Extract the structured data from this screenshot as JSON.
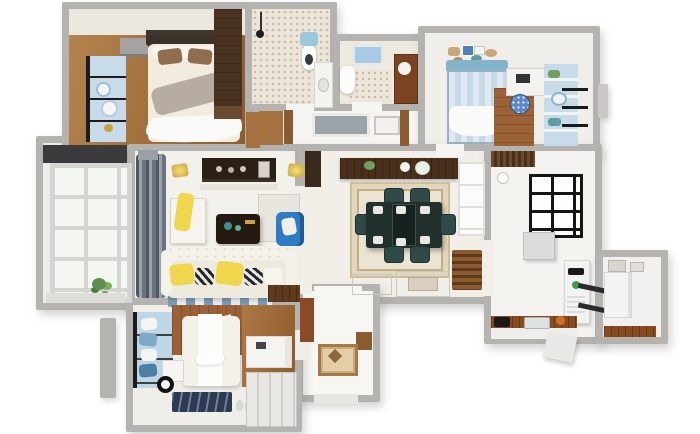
{
  "palette": {
    "bg": "#ffffff",
    "wall": "#b5b3b0",
    "wallLight": "#c9c8c5",
    "floor": "#f3f1ec",
    "floorWarm": "#f2efe9",
    "wood": "#a5713f",
    "woodDark": "#4a3220",
    "woodMid": "#8a5a30",
    "cream": "#f2ecdf",
    "lightBlue": "#c7dbe8",
    "skyBlue": "#9cc7dd",
    "accentBlue": "#2f7cc4",
    "teal": "#2f4a47",
    "yellow": "#efd64d",
    "gold": "#caa23a",
    "navyRug": "#2b3a55",
    "curtain": "#59626c",
    "darkTable": "#241a12",
    "mosaic": "#ece5d8",
    "green": "#6fa05e",
    "white": "#fafaf8"
  },
  "scene": {
    "type": "3d-floorplan-render",
    "view": "top-down dollhouse",
    "rooms": [
      {
        "name": "master-bedroom",
        "position": "top-left",
        "furniture": [
          "double-bed",
          "brown-pillows",
          "gray-throw",
          "wardrobe",
          "dresser",
          "blue-window-shelf"
        ]
      },
      {
        "name": "shower-bathroom",
        "position": "top-center",
        "furniture": [
          "shower-head",
          "toilet",
          "sink-counter"
        ],
        "floor": "mosaic-tile"
      },
      {
        "name": "second-bathroom",
        "position": "top-center-right",
        "furniture": [
          "skylight",
          "toilet",
          "wood-vanity"
        ],
        "floor": "mosaic-tile"
      },
      {
        "name": "hallway",
        "position": "center-top",
        "furniture": [
          "panoramic-artwork",
          "framed-print",
          "wood-door-frames"
        ]
      },
      {
        "name": "kids-bedroom-study",
        "position": "top-right",
        "furniture": [
          "blue-striped-bed",
          "corner-desk",
          "polka-dot-chair",
          "shelf-wall",
          "gallery-picture-frames"
        ]
      },
      {
        "name": "west-balcony",
        "position": "middle-left",
        "furniture": [
          "grid-window",
          "potted-plant"
        ]
      },
      {
        "name": "living-room",
        "position": "middle-left-center",
        "furniture": [
          "tv-console",
          "wall-sconces",
          "gray-curtains",
          "white-cabinet-yellow-throw",
          "coffee-table",
          "blue-armchair",
          "white-sofa",
          "yellow-and-checker-pillows",
          "striped-rug",
          "wood-bench"
        ]
      },
      {
        "name": "dining-room",
        "position": "center",
        "furniture": [
          "sideboard-with-plates",
          "dining-table",
          "six-teal-chairs",
          "bordered-rug",
          "slatted-radiator-bench",
          "inlaid-floor-tiles"
        ]
      },
      {
        "name": "kitchen",
        "position": "right",
        "furniture": [
          "black-grid-partition-window",
          "upper-cabinet",
          "refrigerator-with-magnets",
          "wood-countertop",
          "cooktop",
          "sink",
          "orange-pot"
        ]
      },
      {
        "name": "kitchen-balcony",
        "position": "far-right",
        "furniture": [
          "tall-cabinet",
          "wood-counter",
          "wall-frames"
        ]
      },
      {
        "name": "entry-foyer",
        "position": "bottom-center",
        "furniture": [
          "floor-medallion",
          "wood-shoe-cabinet"
        ]
      },
      {
        "name": "second-bedroom",
        "position": "bottom-left",
        "furniture": [
          "white-bed",
          "wood-plank-accent-wall",
          "window-seat-with-pillows",
          "nightstand",
          "alarm-clock",
          "navy-rug",
          "slippers",
          "corner-desk",
          "wardrobe"
        ]
      }
    ]
  }
}
